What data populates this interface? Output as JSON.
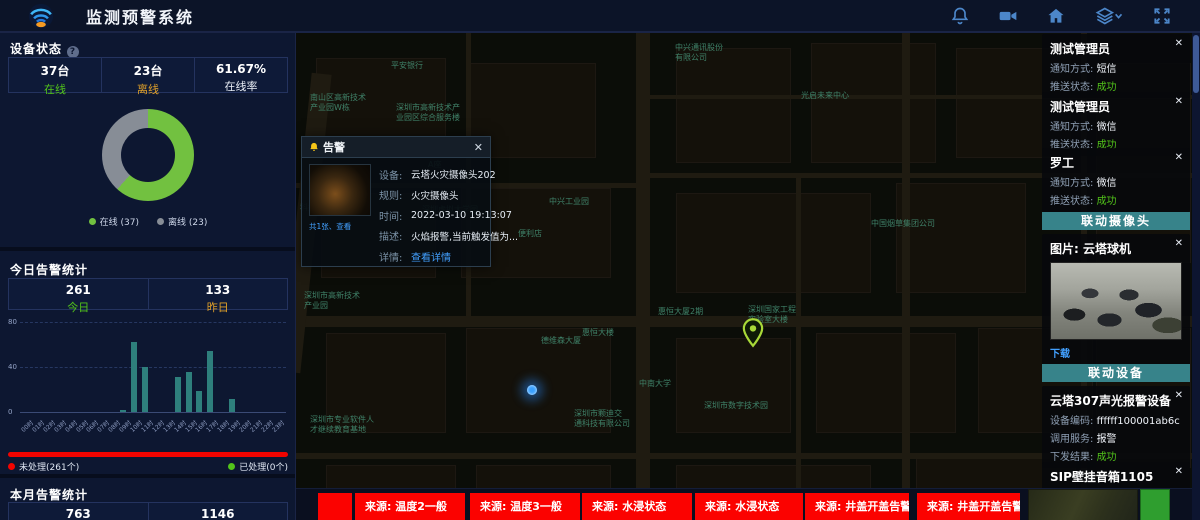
{
  "header": {
    "title": "监测预警系统",
    "icons": [
      "bell",
      "video-camera",
      "home",
      "layers",
      "fullscreen"
    ]
  },
  "colors": {
    "accent_green": "#52c41a",
    "accent_orange": "#e0a029",
    "alert_red": "#f20400",
    "link_blue": "#42a0ff",
    "teal_header": "#37838a",
    "bar_teal": "#2e7f7c",
    "online_green": "#72c140",
    "offline_gray": "#878d96"
  },
  "left_panel": {
    "device_status": {
      "title": "设备状态",
      "help": "?",
      "stats": [
        {
          "value": "37台",
          "label": "在线"
        },
        {
          "value": "23台",
          "label": "离线"
        },
        {
          "value": "61.67%",
          "label": "在线率"
        }
      ],
      "legend": [
        {
          "label": "在线 (37)",
          "color": "#72c140"
        },
        {
          "label": "离线 (23)",
          "color": "#878d96"
        }
      ]
    },
    "today_alerts": {
      "title": "今日告警统计",
      "stats": [
        {
          "value": "261",
          "label": "今日"
        },
        {
          "value": "133",
          "label": "昨日"
        }
      ],
      "progress_legend": [
        {
          "label": "未处理(261个)",
          "color": "#f20400"
        },
        {
          "label": "已处理(0个)",
          "color": "#52c41a"
        }
      ]
    },
    "month_alerts": {
      "title": "本月告警统计",
      "stats": [
        {
          "value": "763"
        },
        {
          "value": "1146"
        }
      ]
    }
  },
  "chart_data": [
    {
      "type": "pie",
      "title": "设备状态",
      "labels": [
        "在线",
        "离线"
      ],
      "values": [
        37,
        23
      ],
      "colors": [
        "#72c140",
        "#878d96"
      ],
      "donut": true,
      "legend_position": "bottom"
    },
    {
      "type": "bar",
      "title": "今日告警统计(按小时)",
      "categories": [
        "00时",
        "01时",
        "02时",
        "03时",
        "04时",
        "05时",
        "06时",
        "07时",
        "08时",
        "09时",
        "10时",
        "11时",
        "12时",
        "13时",
        "14时",
        "15时",
        "16时",
        "17时",
        "18时",
        "19时",
        "20时",
        "21时",
        "22时",
        "23时"
      ],
      "values": [
        0,
        0,
        0,
        0,
        0,
        0,
        0,
        0,
        0,
        2,
        62,
        40,
        0,
        0,
        31,
        36,
        19,
        54,
        0,
        12,
        0,
        0,
        0,
        0
      ],
      "xlabel": "",
      "ylabel": "",
      "ylim": [
        0,
        80
      ],
      "yticks": [
        0,
        40,
        80
      ],
      "bar_color": "#2e7f7c",
      "grid": "dashed"
    }
  ],
  "map": {
    "labels": [
      {
        "text": "中兴通讯股份\n有限公司",
        "x": 379,
        "y": 10
      },
      {
        "text": "平安银行",
        "x": 95,
        "y": 28
      },
      {
        "text": "南山区高新技术\n产业园W栋",
        "x": 14,
        "y": 60
      },
      {
        "text": "深圳市高新技术产\n业园区综合服务楼",
        "x": 100,
        "y": 70
      },
      {
        "text": "光启未来中心",
        "x": 505,
        "y": 58
      },
      {
        "text": "高科机楼",
        "x": 20,
        "y": 103
      },
      {
        "text": "A座",
        "x": 132,
        "y": 127
      },
      {
        "text": "科技园南区附区",
        "x": 4,
        "y": 170
      },
      {
        "text": "深圳虚拟大学园",
        "x": 126,
        "y": 172
      },
      {
        "text": "中兴工业园",
        "x": 253,
        "y": 164
      },
      {
        "text": "便利店",
        "x": 222,
        "y": 196
      },
      {
        "text": "中国烟草集团公司",
        "x": 575,
        "y": 186
      },
      {
        "text": "深圳市高新技术\n产业园",
        "x": 8,
        "y": 258
      },
      {
        "text": "德维森大厦",
        "x": 245,
        "y": 303
      },
      {
        "text": "惠恒大楼",
        "x": 286,
        "y": 295
      },
      {
        "text": "惠恒大厦2期",
        "x": 362,
        "y": 274
      },
      {
        "text": "深圳国家工程\n实验室大楼",
        "x": 452,
        "y": 272
      },
      {
        "text": "中南大学",
        "x": 343,
        "y": 346
      },
      {
        "text": "深圳市数字技术园",
        "x": 408,
        "y": 368
      },
      {
        "text": "深圳市颗迪交\n通科技有限公司",
        "x": 278,
        "y": 376
      },
      {
        "text": "深圳市专业软件人\n才继续教育基地",
        "x": 14,
        "y": 382
      }
    ],
    "markers": [
      {
        "type": "blue-dot",
        "x": 231,
        "y": 352
      },
      {
        "type": "green-pin",
        "x": 446,
        "y": 285
      }
    ]
  },
  "popup": {
    "title": "告警",
    "close": "✕",
    "thumbnail_caption": "共1张、查看",
    "rows": [
      {
        "label": "设备:",
        "value": "云塔火灾摄像头202"
      },
      {
        "label": "规则:",
        "value": "火灾摄像头"
      },
      {
        "label": "时间:",
        "value": "2022-03-10 19:13:07"
      },
      {
        "label": "描述:",
        "value": "火焰报警,当前触发值为..."
      },
      {
        "label": "详情:",
        "value": "查看详情",
        "link": true
      }
    ]
  },
  "right_panel": {
    "notifications": [
      {
        "title": "测试管理员",
        "close": "✕",
        "rows": [
          {
            "label": "通知方式: ",
            "value": "短信"
          },
          {
            "label": "推送状态: ",
            "value": "成功",
            "status": true
          }
        ]
      },
      {
        "title": "测试管理员",
        "close": "✕",
        "rows": [
          {
            "label": "通知方式: ",
            "value": "微信"
          },
          {
            "label": "推送状态: ",
            "value": "成功",
            "status": true
          }
        ]
      },
      {
        "title": "罗工",
        "close": "✕",
        "rows": [
          {
            "label": "通知方式: ",
            "value": "微信"
          },
          {
            "label": "推送状态: ",
            "value": "成功",
            "status": true
          }
        ]
      }
    ],
    "camera_section": {
      "header": "联动摄像头",
      "card": {
        "title": "图片: 云塔球机",
        "close": "✕",
        "download_label": "下载"
      }
    },
    "device_section": {
      "header": "联动设备",
      "cards": [
        {
          "title": "云塔307声光报警设备",
          "close": "✕",
          "rows": [
            {
              "label": "设备编码: ",
              "value": "ffffff100001ab6c"
            },
            {
              "label": "调用服务: ",
              "value": "报警"
            },
            {
              "label": "下发结果: ",
              "value": "成功",
              "status": true
            }
          ]
        },
        {
          "title": "SIP壁挂音箱1105",
          "close": "✕",
          "rows": [
            {
              "label": "设备编码: ",
              "value": "1105"
            }
          ]
        }
      ]
    }
  },
  "ticker": {
    "items": [
      {
        "kind": "alert",
        "text": ""
      },
      {
        "kind": "alert",
        "text": "来源: 温度2一般"
      },
      {
        "kind": "alert",
        "text": "来源: 温度3一般"
      },
      {
        "kind": "alert",
        "text": "来源: 水浸状态"
      },
      {
        "kind": "alert",
        "text": "来源: 水浸状态"
      },
      {
        "kind": "alert",
        "text": "来源: 井盖开盖告警"
      },
      {
        "kind": "alert",
        "text": "来源: 井盖开盖告警"
      },
      {
        "kind": "photo-thumbnail",
        "text": ""
      },
      {
        "kind": "green-thumbnail",
        "text": ""
      }
    ]
  }
}
